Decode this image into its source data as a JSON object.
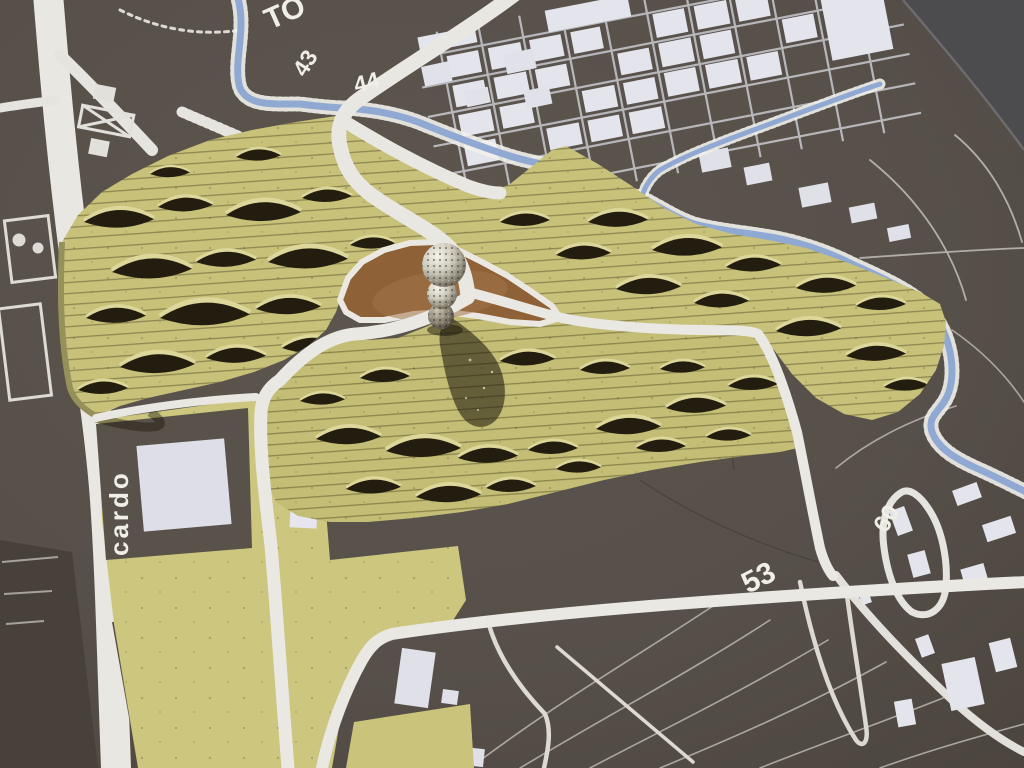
{
  "scene": {
    "kind": "photograph",
    "subject": "physical architectural site model: corrugated paper terrain with sphere tower on a printed city map"
  },
  "labels": {
    "top_left": "TO",
    "contour_43": "43",
    "contour_44": "44",
    "area_53": "53",
    "area_60": "60",
    "street_cardo": "cardo"
  },
  "colors": {
    "map_base": "#57504a",
    "map_dark_corner": "#4c4b4e",
    "map_lines": "#eae8e2",
    "buildings_white": "#e3e4ec",
    "river_blue": "#90a9d2",
    "terrain_yellow": "#c8c17a",
    "terrain_slit_shadow": "#231d10",
    "clearing_brown": "#8e6137",
    "tower_metal": "#cdc9bb"
  }
}
